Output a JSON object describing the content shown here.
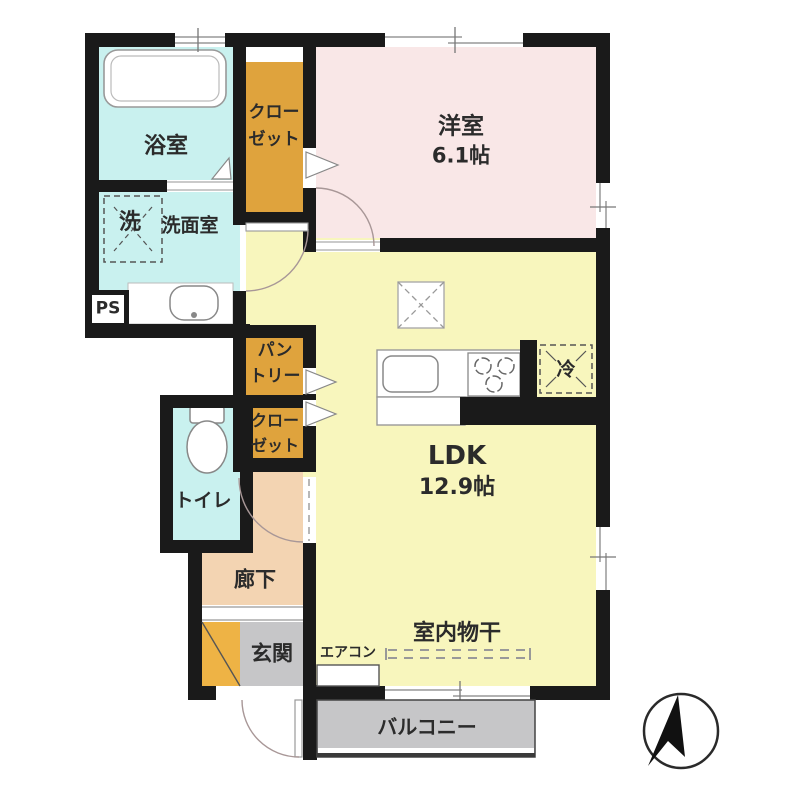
{
  "plan_title": "1LDK floor plan",
  "rooms": {
    "bathroom": {
      "label": "浴室"
    },
    "washer_space": {
      "label": "洗"
    },
    "washroom": {
      "label": "洗面室"
    },
    "pipe_space": {
      "label": "PS"
    },
    "closet_top": {
      "line1": "クロー",
      "line2": "ゼット"
    },
    "western_room": {
      "label": "洋室",
      "size": "6.1帖"
    },
    "pantry": {
      "line1": "パン",
      "line2": "トリー"
    },
    "closet_mid": {
      "line1": "クロー",
      "line2": "ゼット"
    },
    "toilet": {
      "label": "トイレ"
    },
    "hallway": {
      "label": "廊下"
    },
    "entrance": {
      "label": "玄関"
    },
    "ldk": {
      "label": "LDK",
      "size": "12.9帖"
    },
    "refrigerator": {
      "label": "冷"
    },
    "air_conditioner": {
      "label": "エアコン"
    },
    "indoor_drying": {
      "label": "室内物干"
    },
    "balcony": {
      "label": "バルコニー"
    }
  },
  "colors": {
    "wall": "#1a1a1a",
    "wet_rooms": "#c9f1ef",
    "western_room": "#f9e7e7",
    "ldk": "#f8f6bd",
    "storage_orange": "#dfa33d",
    "shoe_cabinet_orange": "#eeb345",
    "hallway_peach": "#f3d4b2",
    "gray_areas": "#c6c6c8"
  },
  "compass": {
    "name": "north-arrow"
  }
}
